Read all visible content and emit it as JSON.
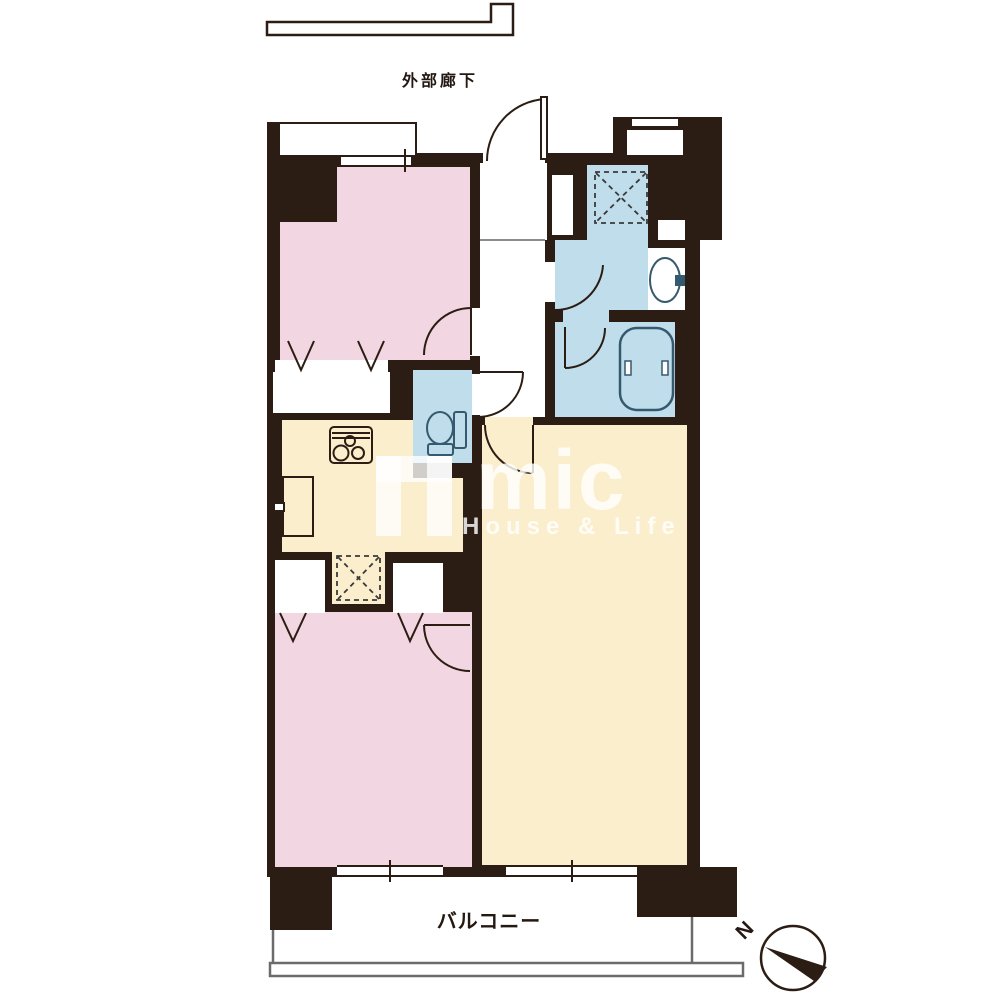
{
  "palette": {
    "wall": "#2b1d13",
    "room_pink": "#f2d6e1",
    "room_cream": "#fbeecd",
    "room_blue": "#c0ddeb",
    "fixture_line": "#35596e",
    "ink": "#241812"
  },
  "labels": {
    "exterior_corridor": "外部廊下",
    "outdoor_unit": "室外機置場",
    "meter_box": "MB",
    "entrance": "玄関",
    "shoe_box": "下駄箱",
    "washer": "洗",
    "washroom": "洗面室",
    "hall": "ホール",
    "bathroom": "浴室",
    "toilet": "トイレ",
    "closet1": "クローゼット",
    "bedroom1_name": "洋室",
    "bedroom1_size": "約4.7帖",
    "kitchen_name": "K",
    "kitchen_size": "約3.1帖",
    "storage": "物入",
    "fridge": "冷",
    "closet2_line1": "クロー",
    "closet2_line2": "ゼット",
    "bedroom2_name": "洋室",
    "bedroom2_size": "約5.8帖",
    "ld_name": "LD",
    "ld_size": "約10.3帖",
    "balcony": "バルコニー"
  },
  "compass": {
    "north_label": "N"
  },
  "watermark": {
    "logo_text": "mic",
    "tagline": "House & Life"
  }
}
